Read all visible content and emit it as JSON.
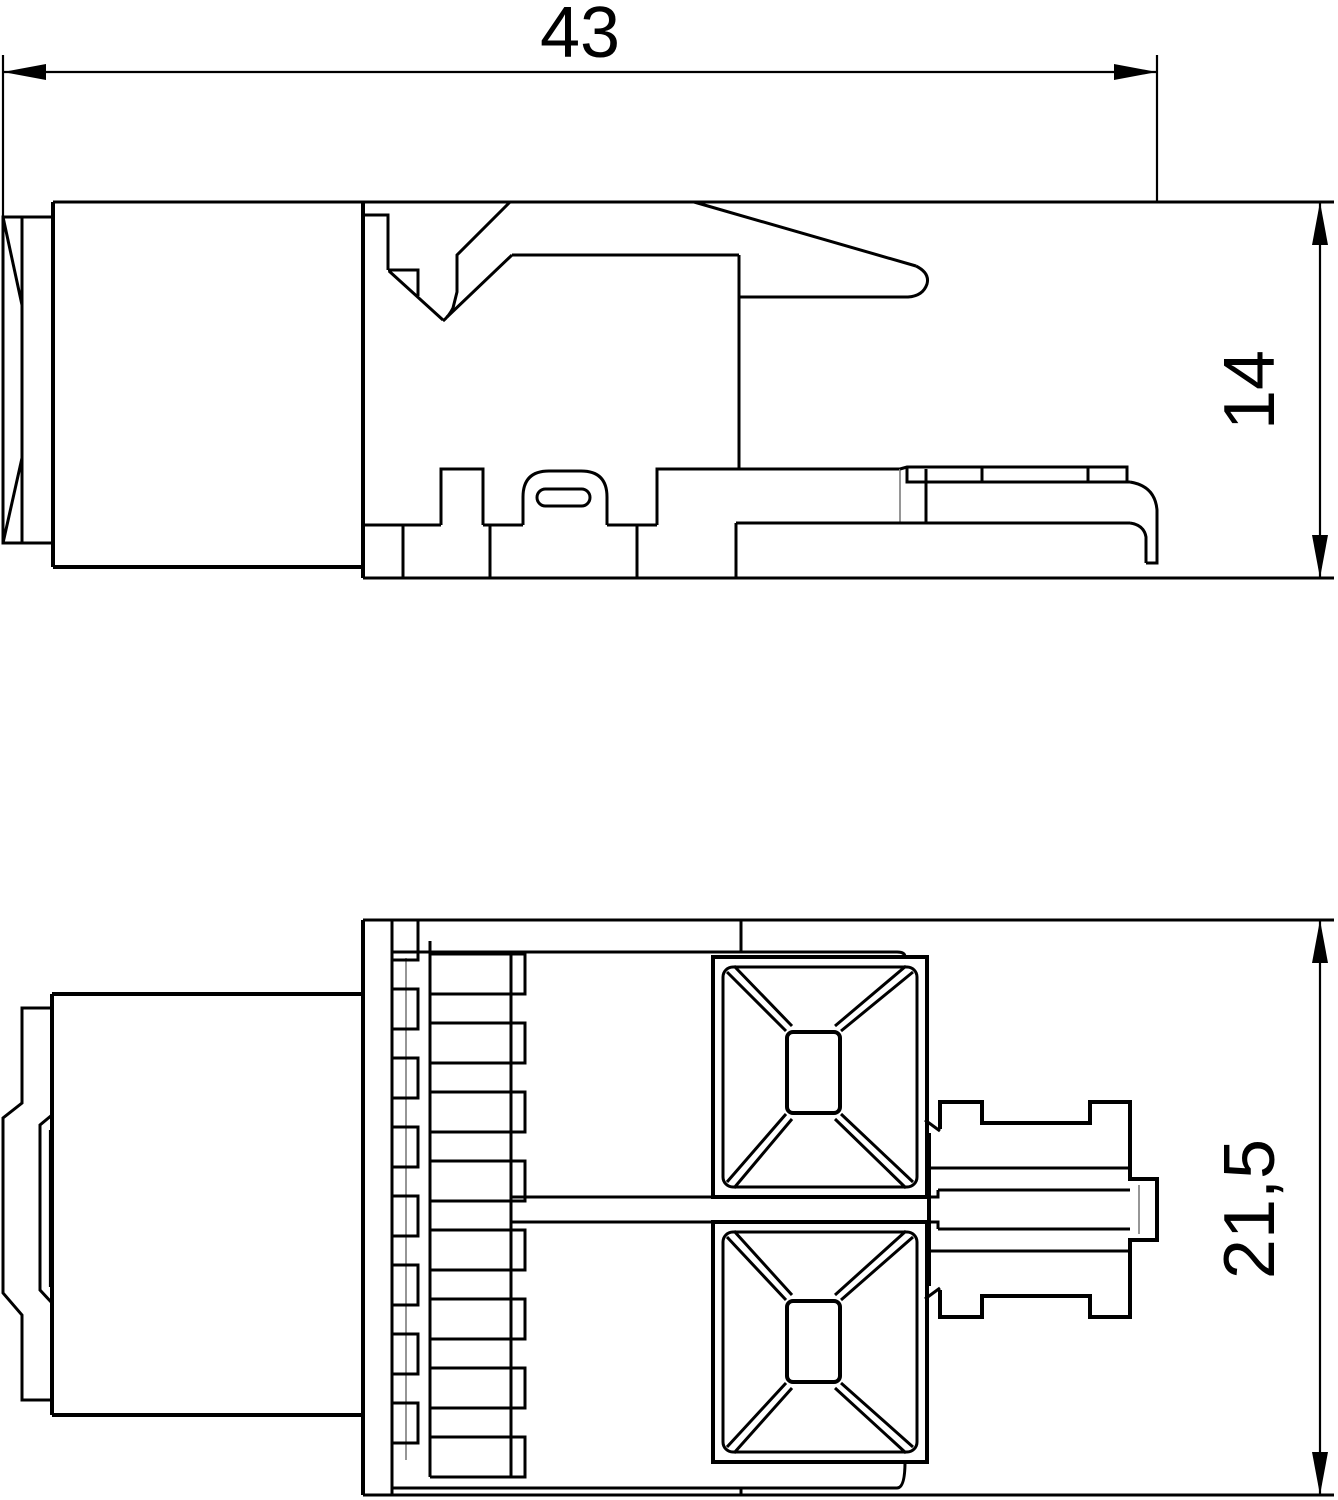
{
  "drawing": {
    "kind": "dimensioned-technical-drawing",
    "background_color": "#ffffff",
    "line_color": "#000000",
    "thin_line_color": "#8a8a8a",
    "views": 2
  },
  "dimensions": {
    "overall_length": "43",
    "overall_height": "14",
    "overall_width": "21,5"
  }
}
